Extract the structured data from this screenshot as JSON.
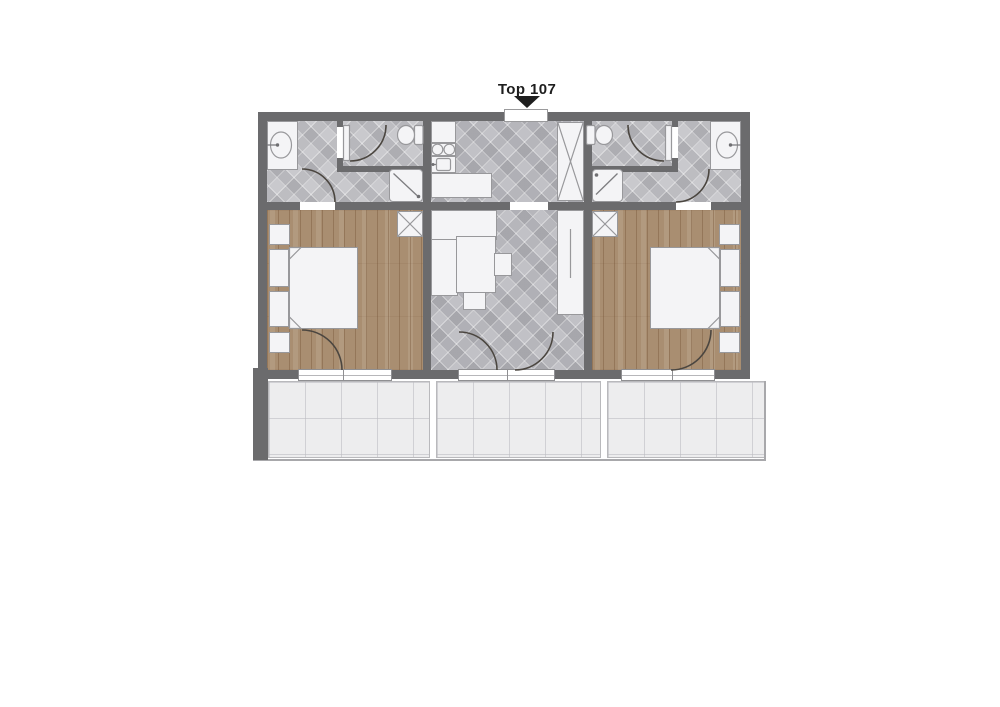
{
  "unit": {
    "label": "Top 107"
  },
  "colors": {
    "wall": "#6B6B6D",
    "bath-tile": "#C9C9CD",
    "hall-tile": "#C1C1C6",
    "wood": "#A98E71",
    "balcony": "#EDEDEE",
    "fixture": "#F4F4F6",
    "outline": "#98989B",
    "arc": "#4B4640",
    "ink": "#1E1E1E"
  }
}
